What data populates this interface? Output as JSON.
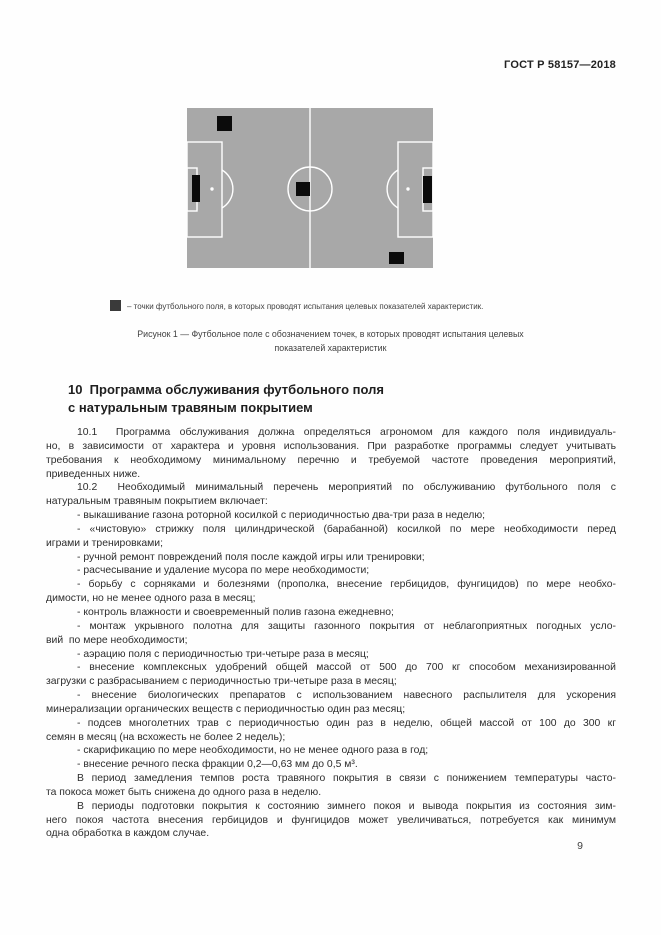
{
  "header": {
    "doc_code": "ГОСТ Р 58157—2018"
  },
  "figure": {
    "type": "diagram",
    "subject": "football-field-with-test-points",
    "colors": {
      "field": "#a8a8a8",
      "line": "#ffffff",
      "marker": "#0b0b0b",
      "legend_swatch": "#3a3a3a"
    },
    "points": [
      {
        "x": 30,
        "y": 8,
        "w": 15,
        "h": 15
      },
      {
        "x": 109,
        "y": 74,
        "w": 14,
        "h": 14
      },
      {
        "x": 202,
        "y": 144,
        "w": 15,
        "h": 12
      },
      {
        "x": 5,
        "y": 67,
        "w": 8,
        "h": 27
      },
      {
        "x": 236,
        "y": 68,
        "w": 9,
        "h": 27
      }
    ],
    "legend_text": "– точки футбольного поля, в которых проводят испытания целевых показателей характеристик.",
    "caption_line1": "Рисунок 1 — Футбольное поле с обозначением точек, в которых проводят испытания целевых",
    "caption_line2": "показателей характеристик"
  },
  "section": {
    "heading_line1": "10  Программа обслуживания футбольного поля",
    "heading_line2": "с натуральным травяным покрытием"
  },
  "body": {
    "lines": [
      {
        "indent": true,
        "text": "10.1  Программа обслуживания должна определяться агрономом для каждого поля индивидуаль-"
      },
      {
        "text": "но, в зависимости от характера и уровня использования. При разработке программы следует учитывать"
      },
      {
        "text": "требования к необходимому минимальному перечню и требуемой частоте проведения мероприятий,"
      },
      {
        "last": true,
        "text": "приведенных ниже."
      },
      {
        "indent": true,
        "text": "10.2  Необходимый минимальный перечень мероприятий по обслуживанию футбольного поля с"
      },
      {
        "last": true,
        "text": "натуральным травяным покрытием включает:"
      },
      {
        "indent": true,
        "last": true,
        "text": "- выкашивание газона роторной косилкой с периодичностью два-три раза в неделю;"
      },
      {
        "indent": true,
        "text": "- «чистовую» стрижку поля цилиндрической (барабанной) косилкой по мере необходимости перед"
      },
      {
        "last": true,
        "text": "играми и тренировками;"
      },
      {
        "indent": true,
        "last": true,
        "text": "- ручной ремонт повреждений поля после каждой игры или тренировки;"
      },
      {
        "indent": true,
        "last": true,
        "text": "- расчесывание и удаление мусора по мере необходимости;"
      },
      {
        "indent": true,
        "text": "- борьбу с сорняками и болезнями (прополка, внесение гербицидов, фунгицидов) по мере необхо-"
      },
      {
        "last": true,
        "text": "димости, но не менее одного раза в месяц;"
      },
      {
        "indent": true,
        "last": true,
        "text": "- контроль влажности и своевременный полив газона ежедневно;"
      },
      {
        "indent": true,
        "text": "- монтаж укрывного полотна для защиты газонного покрытия от неблагоприятных погодных усло-"
      },
      {
        "last": true,
        "text": "вий  по мере необходимости;"
      },
      {
        "indent": true,
        "last": true,
        "text": "- аэрацию поля с периодичностью три-четыре раза в месяц;"
      },
      {
        "indent": true,
        "text": "- внесение комплексных удобрений общей массой от 500 до 700 кг способом механизированной"
      },
      {
        "last": true,
        "text": "загрузки с разбрасыванием с периодичностью три-четыре раза в месяц;"
      },
      {
        "indent": true,
        "text": "- внесение биологических препаратов с использованием навесного распылителя для ускорения"
      },
      {
        "last": true,
        "text": "минерализации органических веществ с периодичностью один раз месяц;"
      },
      {
        "indent": true,
        "text": "- подсев многолетних трав с периодичностью один раз в неделю, общей массой от 100 до 300 кг"
      },
      {
        "last": true,
        "text": "семян в месяц (на всхожесть не более 2 недель);"
      },
      {
        "indent": true,
        "last": true,
        "text": "- скарификацию по мере необходимости, но не менее одного раза в год;"
      },
      {
        "indent": true,
        "last": true,
        "text": "- внесение речного песка фракции 0,2—0,63 мм до 0,5 м³."
      },
      {
        "indent": true,
        "text": "В период замедления темпов роста травяного покрытия в связи с понижением температуры часто-"
      },
      {
        "last": true,
        "text": "та покоса может быть снижена до одного раза в неделю."
      },
      {
        "indent": true,
        "text": "В периоды подготовки покрытия к состоянию зимнего покоя и вывода покрытия из состояния зим-"
      },
      {
        "text": "него покоя частота внесения гербицидов и фунгицидов может увеличиваться, потребуется как минимум"
      },
      {
        "last": true,
        "text": "одна обработка в каждом случае."
      }
    ]
  },
  "footer": {
    "page_number": "9"
  }
}
